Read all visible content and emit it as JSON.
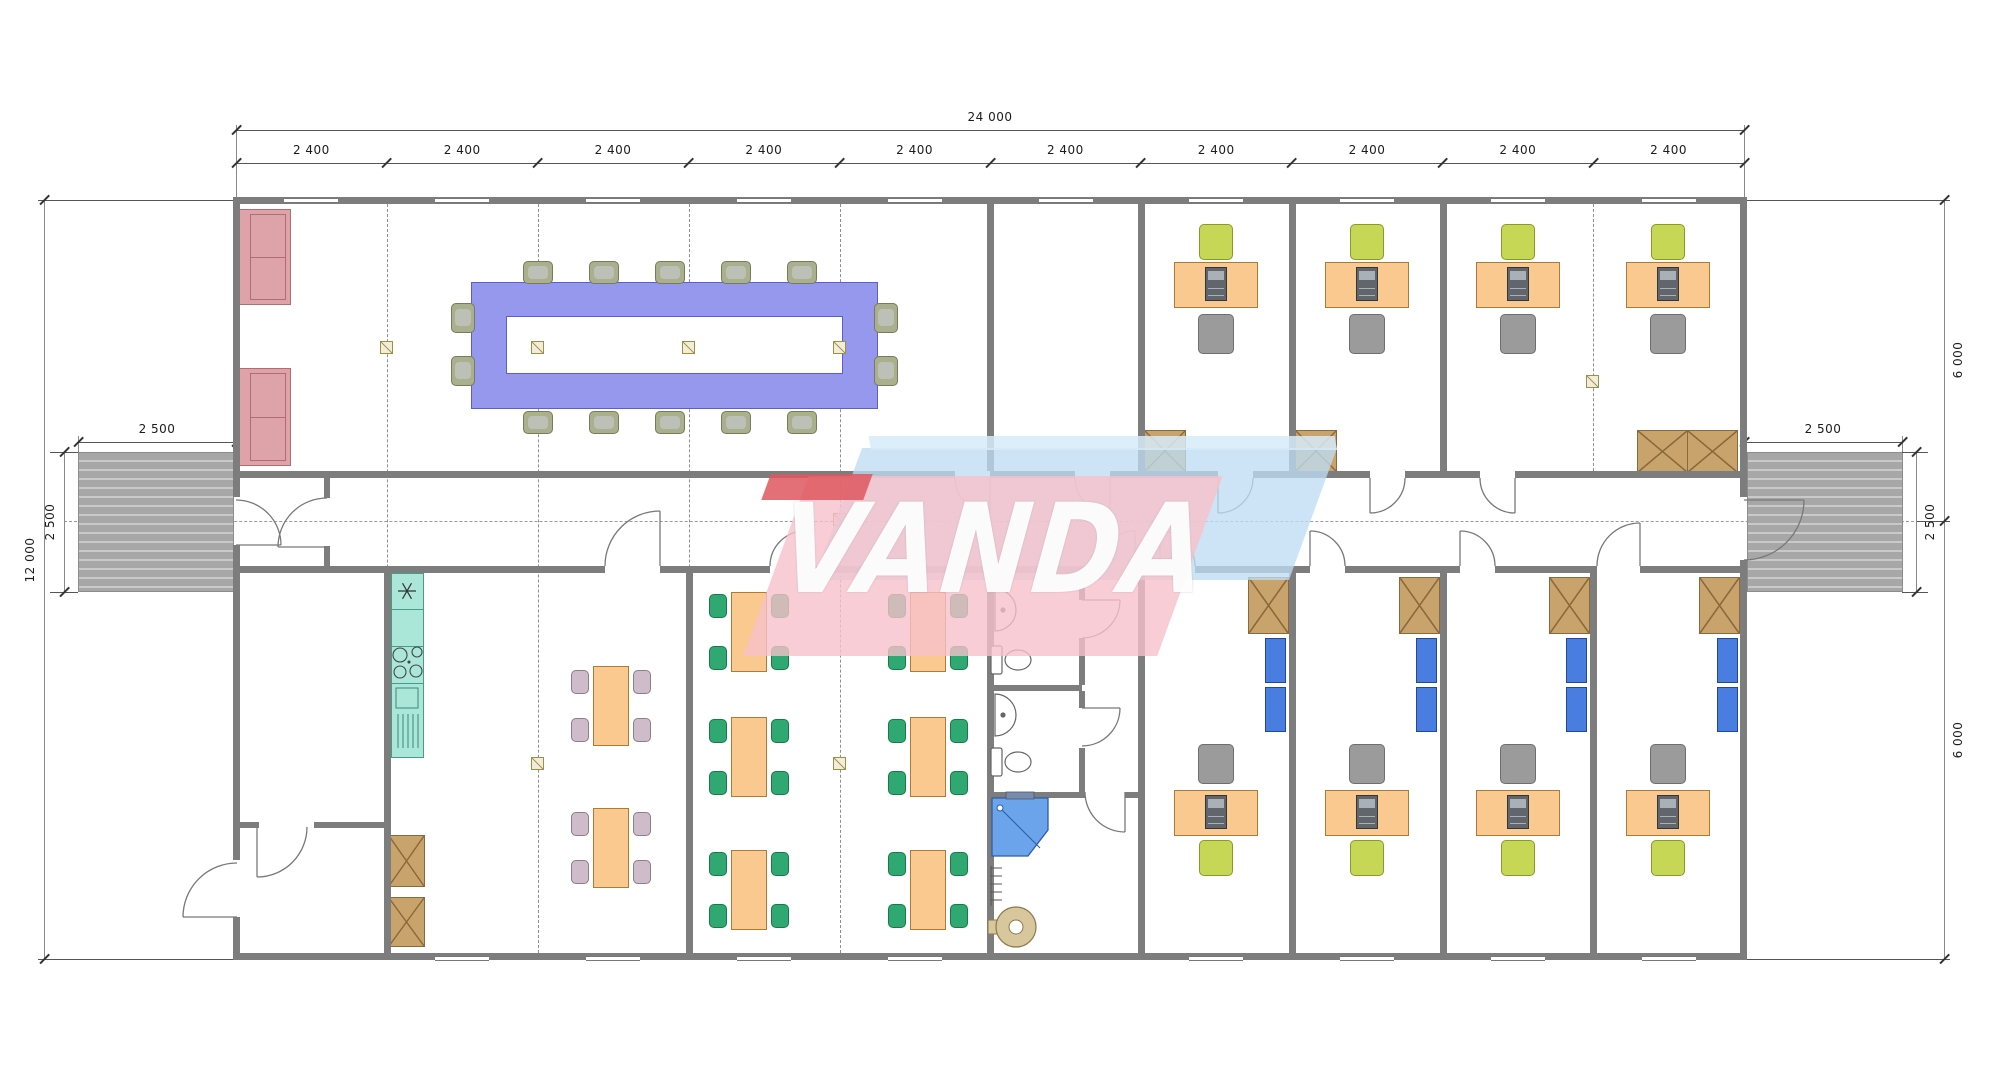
{
  "title": "Modular office building floor plan",
  "watermark": {
    "text": "VANDA"
  },
  "dimensions": {
    "overall_width": "24 000",
    "bay_width": "2 400",
    "bay_count": 10,
    "building_height": "12 000",
    "half_height_top": "6 000",
    "half_height_bottom": "6 000",
    "ramp_width": "2 500",
    "ramp_depth": "2 500"
  },
  "colors": {
    "wall": "#7d7d7d",
    "table_purple": "#9598ec",
    "table_purple_edge": "#5b5ed0",
    "sofa_pink": "#dda3a8",
    "sofa_edge": "#b06d74",
    "desk_orange": "#f9c98f",
    "desk_edge": "#b07a35",
    "chair_green": "#2fa871",
    "chair_green_edge": "#187a4a",
    "chair_lime": "#c5d755",
    "chair_lime_edge": "#8a9a2a",
    "chair_gray": "#9b9b9b",
    "chair_gray_edge": "#6e6e6e",
    "chair_mauve": "#cfbccb",
    "chair_mauve_edge": "#8d7d8d",
    "chair_olive": "#aab08e",
    "chair_olive_edge": "#767c5c",
    "kitchen_teal": "#abe7d9",
    "kitchen_edge": "#4a9a8a",
    "wardrobe_brown": "#c9a36c",
    "wardrobe_edge": "#8a6a3a",
    "cabinet_blue": "#4a7de0",
    "cabinet_edge": "#23479c",
    "shower_blue": "#6ba4ea",
    "boiler_beige": "#d8c79c",
    "pc_dark": "#61666d",
    "watermark_pink": "rgba(248,193,203,0.80)",
    "watermark_red": "rgba(222,87,94,0.85)",
    "watermark_blue": "rgba(190,221,242,0.78)"
  },
  "rooms": [
    {
      "name": "meeting-room"
    },
    {
      "name": "office-top-spare"
    },
    {
      "name": "office-top-1"
    },
    {
      "name": "office-top-2"
    },
    {
      "name": "office-top-double"
    },
    {
      "name": "corridor"
    },
    {
      "name": "entry-hall"
    },
    {
      "name": "storage-room"
    },
    {
      "name": "kitchen-canteen"
    },
    {
      "name": "dining-room"
    },
    {
      "name": "wc-room-1"
    },
    {
      "name": "wc-room-2"
    },
    {
      "name": "shower-room"
    },
    {
      "name": "office-bottom-1"
    },
    {
      "name": "office-bottom-2"
    },
    {
      "name": "office-bottom-3"
    },
    {
      "name": "office-bottom-4"
    }
  ],
  "furniture_summary": {
    "conference_seats": 14,
    "sofas": 2,
    "office_desks": 8,
    "canteen_tables": 2,
    "dining_tables": 6,
    "wardrobes": 11,
    "wall_cabinets": 8,
    "toilets": 2,
    "basins": 2,
    "showers": 1,
    "boilers": 1,
    "ramps": 2
  }
}
